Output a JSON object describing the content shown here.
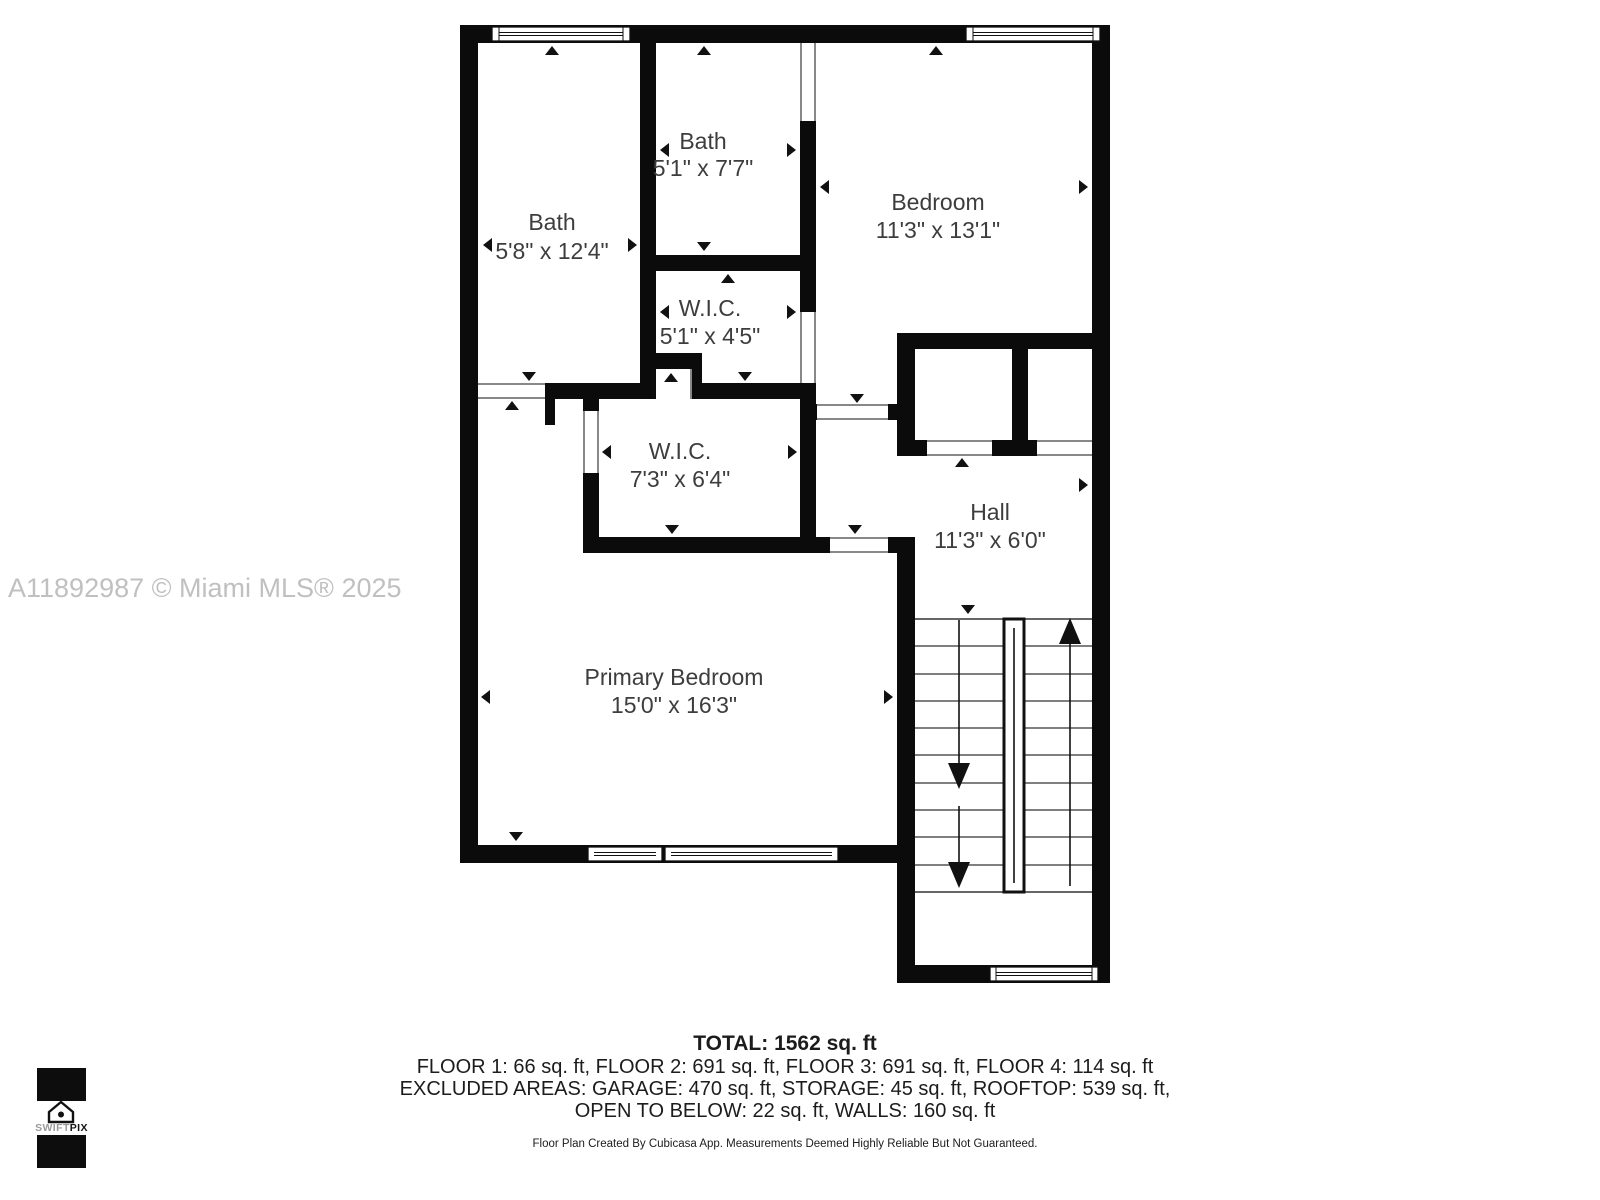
{
  "watermark": "A11892987 © Miami MLS® 2025",
  "rooms": [
    {
      "name": "Bath",
      "dims": "5'8\" x 12'4\""
    },
    {
      "name": "Bath",
      "dims": "5'1\" x 7'7\""
    },
    {
      "name": "W.I.C.",
      "dims": "5'1\" x 4'5\""
    },
    {
      "name": "Bedroom",
      "dims": "11'3\" x 13'1\""
    },
    {
      "name": "W.I.C.",
      "dims": "7'3\" x 6'4\""
    },
    {
      "name": "Hall",
      "dims": "11'3\" x 6'0\""
    },
    {
      "name": "Primary Bedroom",
      "dims": "15'0\" x 16'3\""
    }
  ],
  "footer": {
    "total": "TOTAL: 1562 sq. ft",
    "line2": "FLOOR 1: 66 sq. ft, FLOOR 2: 691 sq. ft, FLOOR 3: 691 sq. ft, FLOOR 4: 114 sq. ft",
    "line3": "EXCLUDED AREAS: GARAGE: 470 sq. ft, STORAGE: 45 sq. ft, ROOFTOP: 539 sq. ft,",
    "line4": "OPEN TO BELOW: 22 sq. ft, WALLS: 160 sq. ft",
    "disclaimer": "Floor Plan Created By Cubicasa App. Measurements Deemed Highly Reliable But Not Guaranteed."
  },
  "logo": {
    "text_light": "SWIFT",
    "text_bold": "PIX"
  },
  "colors": {
    "wall": "#0b0b0b",
    "room_text": "#3d3d3d",
    "watermark": "#c0c0c0",
    "footer_text": "#1c1c1c"
  }
}
